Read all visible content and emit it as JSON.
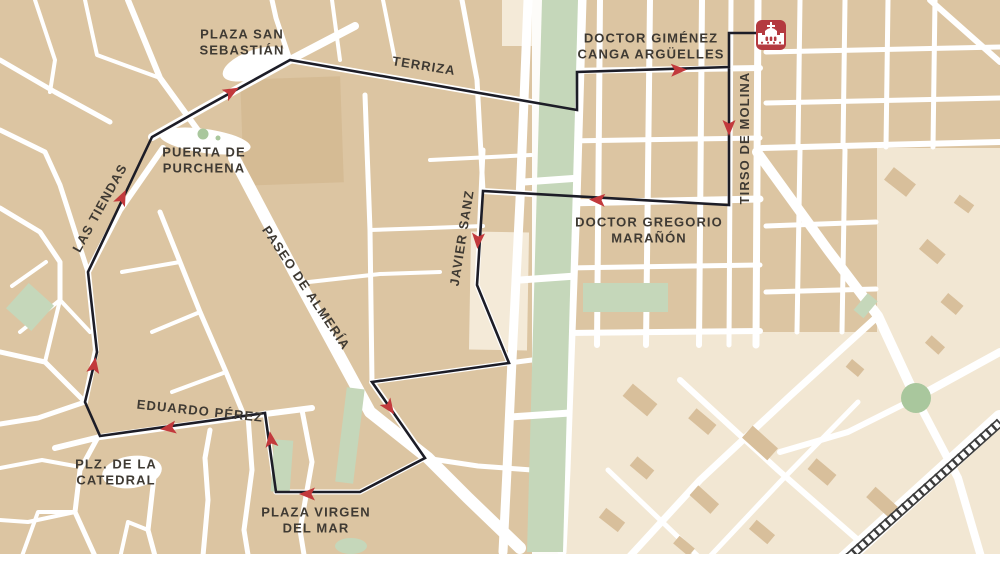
{
  "map": {
    "title": "Walking route through the centre of Almería",
    "colors": {
      "street_white": "#ffffff",
      "block_tan": "#dcc5a2",
      "block_tan_dark": "#d5bb94",
      "block_cream": "#f4ead8",
      "park_green": "#c5d7ba",
      "route_line": "#1d1d27",
      "route_arrow": "#c2393c",
      "marker_red": "#b43a3f",
      "label_text": "#3f3a33",
      "railway": "#3d3d3d"
    },
    "marker": {
      "name": "church-marker",
      "x": 771,
      "y": 35,
      "color": "#b43a3f"
    },
    "route": {
      "color": "#1d1d27",
      "arrow_color": "#c2393c",
      "width": 2.6,
      "points": [
        [
          757,
          33
        ],
        [
          729,
          33
        ],
        [
          729,
          205
        ],
        [
          483,
          191
        ],
        [
          477,
          285
        ],
        [
          509,
          363
        ],
        [
          372,
          382
        ],
        [
          425,
          458
        ],
        [
          360,
          492
        ],
        [
          276,
          492
        ],
        [
          265,
          413
        ],
        [
          100,
          436
        ],
        [
          85,
          402
        ],
        [
          97,
          352
        ],
        [
          88,
          272
        ],
        [
          152,
          137
        ],
        [
          205,
          107
        ],
        [
          290,
          60
        ],
        [
          577,
          110
        ],
        [
          577,
          72
        ],
        [
          729,
          67
        ],
        [
          729,
          36
        ]
      ],
      "arrows": [
        {
          "x": 729,
          "y": 127,
          "angle": 90
        },
        {
          "x": 598,
          "y": 200,
          "angle": 183
        },
        {
          "x": 478,
          "y": 240,
          "angle": 94
        },
        {
          "x": 389,
          "y": 407,
          "angle": 55
        },
        {
          "x": 308,
          "y": 494,
          "angle": 180
        },
        {
          "x": 271,
          "y": 440,
          "angle": -98
        },
        {
          "x": 169,
          "y": 428,
          "angle": 172
        },
        {
          "x": 94,
          "y": 366,
          "angle": -80
        },
        {
          "x": 122,
          "y": 198,
          "angle": -65
        },
        {
          "x": 231,
          "y": 92,
          "angle": -29
        },
        {
          "x": 678,
          "y": 70,
          "angle": -2
        }
      ]
    },
    "labels": [
      {
        "name": "plaza-san-sebastian",
        "lines": [
          "PLAZA SAN",
          "SEBASTIÁN"
        ],
        "x": 242,
        "y": 42,
        "rotation": 0,
        "size": 13
      },
      {
        "name": "terriza",
        "lines": [
          "TERRIZA"
        ],
        "x": 424,
        "y": 66,
        "rotation": 9,
        "size": 13
      },
      {
        "name": "doctor-gimenez-canga-arguelles",
        "lines": [
          "DOCTOR GIMÉNEZ",
          "CANGA ARGÜELLES"
        ],
        "x": 651,
        "y": 46,
        "rotation": 0,
        "size": 13
      },
      {
        "name": "tirso-de-molina",
        "lines": [
          "TIRSO DE MOLINA"
        ],
        "x": 745,
        "y": 138,
        "rotation": -90,
        "size": 13
      },
      {
        "name": "doctor-gregorio-maranon",
        "lines": [
          "DOCTOR GREGORIO",
          "MARAÑÓN"
        ],
        "x": 649,
        "y": 230,
        "rotation": 0,
        "size": 13
      },
      {
        "name": "javier-sanz",
        "lines": [
          "JAVIER SANZ"
        ],
        "x": 462,
        "y": 238,
        "rotation": -81,
        "size": 13
      },
      {
        "name": "paseo-de-almeria",
        "lines": [
          "PASEO DE ALMERÍA"
        ],
        "x": 306,
        "y": 288,
        "rotation": 56,
        "size": 13
      },
      {
        "name": "las-tiendas",
        "lines": [
          "LAS TIENDAS"
        ],
        "x": 100,
        "y": 208,
        "rotation": -61,
        "size": 13
      },
      {
        "name": "puerta-de-purchena",
        "lines": [
          "PUERTA DE",
          "PURCHENA"
        ],
        "x": 204,
        "y": 160,
        "rotation": 0,
        "size": 13
      },
      {
        "name": "eduardo-perez",
        "lines": [
          "EDUARDO PÉREZ"
        ],
        "x": 200,
        "y": 411,
        "rotation": 6,
        "size": 13
      },
      {
        "name": "plaza-de-la-catedral",
        "lines": [
          "PLZ. DE LA",
          "CATEDRAL"
        ],
        "x": 116,
        "y": 472,
        "rotation": 0,
        "size": 13
      },
      {
        "name": "plaza-virgen-del-mar",
        "lines": [
          "PLAZA VIRGEN",
          "DEL MAR"
        ],
        "x": 316,
        "y": 520,
        "rotation": 0,
        "size": 13
      }
    ]
  }
}
